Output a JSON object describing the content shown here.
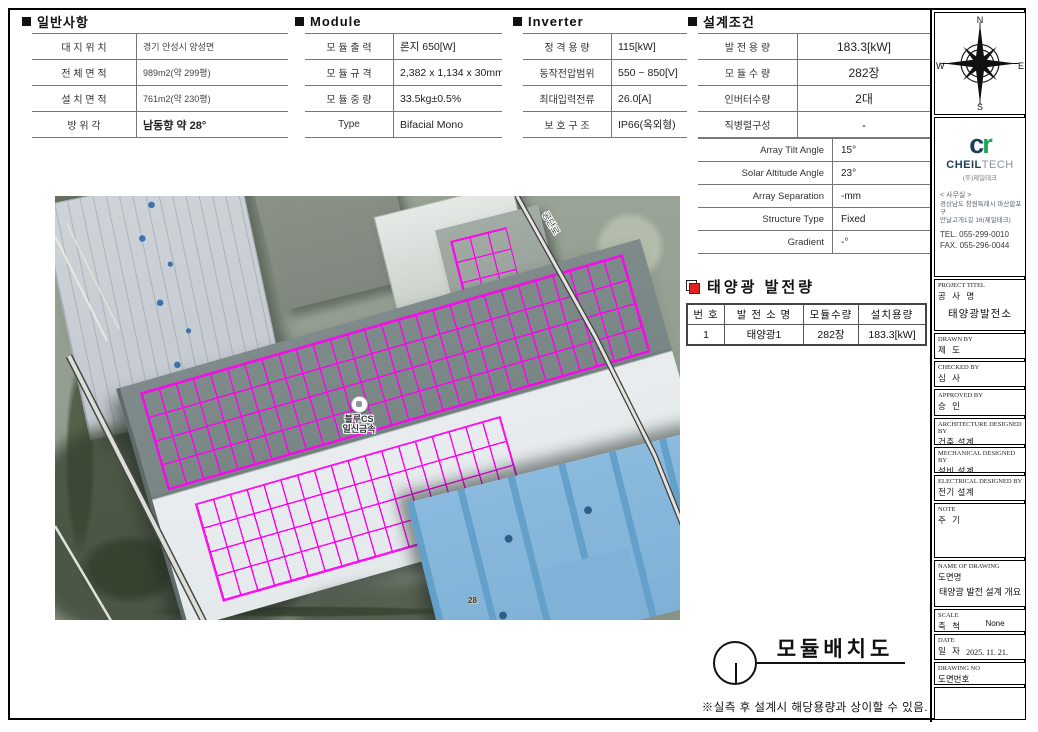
{
  "sections": {
    "general": {
      "title": "일반사항",
      "rows": [
        {
          "label": "대 지 위 치",
          "value": "경기 안성시 양성면"
        },
        {
          "label": "전 체 면 적",
          "value": "989m2(약 299평)"
        },
        {
          "label": "설 치 면 적",
          "value": "761m2(약 230평)"
        },
        {
          "label": "방  위  각",
          "value": "남동향 약 28°"
        }
      ]
    },
    "module": {
      "title": "Module",
      "rows": [
        {
          "label": "모 듈 출 력",
          "value": "론지 650[W]"
        },
        {
          "label": "모 듈 규 격",
          "value": "2,382 x 1,134 x 30mm"
        },
        {
          "label": "모 듈 중 량",
          "value": "33.5kg±0.5%"
        },
        {
          "label": "Type",
          "value": "Bifacial Mono"
        }
      ]
    },
    "inverter": {
      "title": "Inverter",
      "rows": [
        {
          "label": "정 격 용 량",
          "value": "115[kW]"
        },
        {
          "label": "동작전압범위",
          "value": "550 ~ 850[V]"
        },
        {
          "label": "최대입력전류",
          "value": "26.0[A]"
        },
        {
          "label": "보 호 구 조",
          "value": "IP66(옥외형)"
        }
      ]
    },
    "design": {
      "title": "설계조건",
      "rows": [
        {
          "label": "발 전 용 량",
          "value": "183.3[kW]"
        },
        {
          "label": "모 듈 수 량",
          "value": "282장"
        },
        {
          "label": "인버터수량",
          "value": "2대"
        },
        {
          "label": "직병렬구성",
          "value": "-"
        }
      ],
      "rows2": [
        {
          "label": "Array Tilt Angle",
          "value": "15°"
        },
        {
          "label": "Solar Altitude Angle",
          "value": "23°"
        },
        {
          "label": "Array Separation",
          "value": "-mm"
        },
        {
          "label": "Structure Type",
          "value": "Fixed"
        },
        {
          "label": "Gradient",
          "value": "-°"
        }
      ]
    },
    "generation": {
      "title": "태양광 발전량",
      "headers": [
        "번 호",
        "발 전 소 명",
        "모듈수량",
        "설치용량"
      ],
      "row": [
        "1",
        "태양광1",
        "282장",
        "183.3[kW]"
      ]
    }
  },
  "map": {
    "pin_label_line1": "블루CS",
    "pin_label_line2": "일신금속",
    "road_label": "공단로",
    "marker_label": "28"
  },
  "footer": {
    "drawing_title": "모듈배치도",
    "note": "※실측 후 설계시 해당용량과 상이할 수 있음."
  },
  "sidebar": {
    "compass": {
      "n": "N",
      "e": "E",
      "s": "S",
      "w": "W"
    },
    "logo": {
      "mark_c": "c",
      "mark_r": "r",
      "name_bold": "CHEIL",
      "name_light": "TECH",
      "subtitle": "(주)제일테크",
      "office": "< 사무실 >",
      "address1": "경상남도 창원특례시 마산합포구",
      "address2": "만날고개1길 16(제일테크)",
      "tel": "TEL. 055-299-0010",
      "fax": "FAX. 055-296-0044"
    },
    "blocks": {
      "project": {
        "en": "PROJECT TITEL",
        "kr": "공 사 명",
        "value": "태양광발전소"
      },
      "drawn": {
        "en": "DRAWN BY",
        "kr": "제  도",
        "value": ""
      },
      "checked": {
        "en": "CHECKED BY",
        "kr": "심  사",
        "value": ""
      },
      "approved": {
        "en": "APPROVED BY",
        "kr": "승  인",
        "value": ""
      },
      "arch": {
        "en": "ARCHITECTURE DESIGNED BY",
        "kr": "건축 설계",
        "value": ""
      },
      "mech": {
        "en": "MECHANICAL DESIGNED BY",
        "kr": "설비 설계",
        "value": ""
      },
      "elec": {
        "en": "ELECTRICAL DESIGNED BY",
        "kr": "전기 설계",
        "value": ""
      },
      "note": {
        "en": "NOTE",
        "kr": "주  기",
        "value": ""
      },
      "drawing_name": {
        "en": "NAME OF DRAWING",
        "kr": "도면명",
        "value": "태양광 발전 설계 개요"
      },
      "scale": {
        "en": "SCALE",
        "kr": "축  척",
        "value": "None"
      },
      "date": {
        "en": "DATE",
        "kr": "일  자",
        "value": "2025. 11. 21."
      },
      "drawing_no": {
        "en": "DRAWING NO",
        "kr": "도면번호",
        "value": ""
      }
    }
  },
  "colors": {
    "accent_magenta": "#ff00f0",
    "logo_navy": "#1e3c5a",
    "logo_green": "#17a75c",
    "icon_red": "#e02121"
  }
}
